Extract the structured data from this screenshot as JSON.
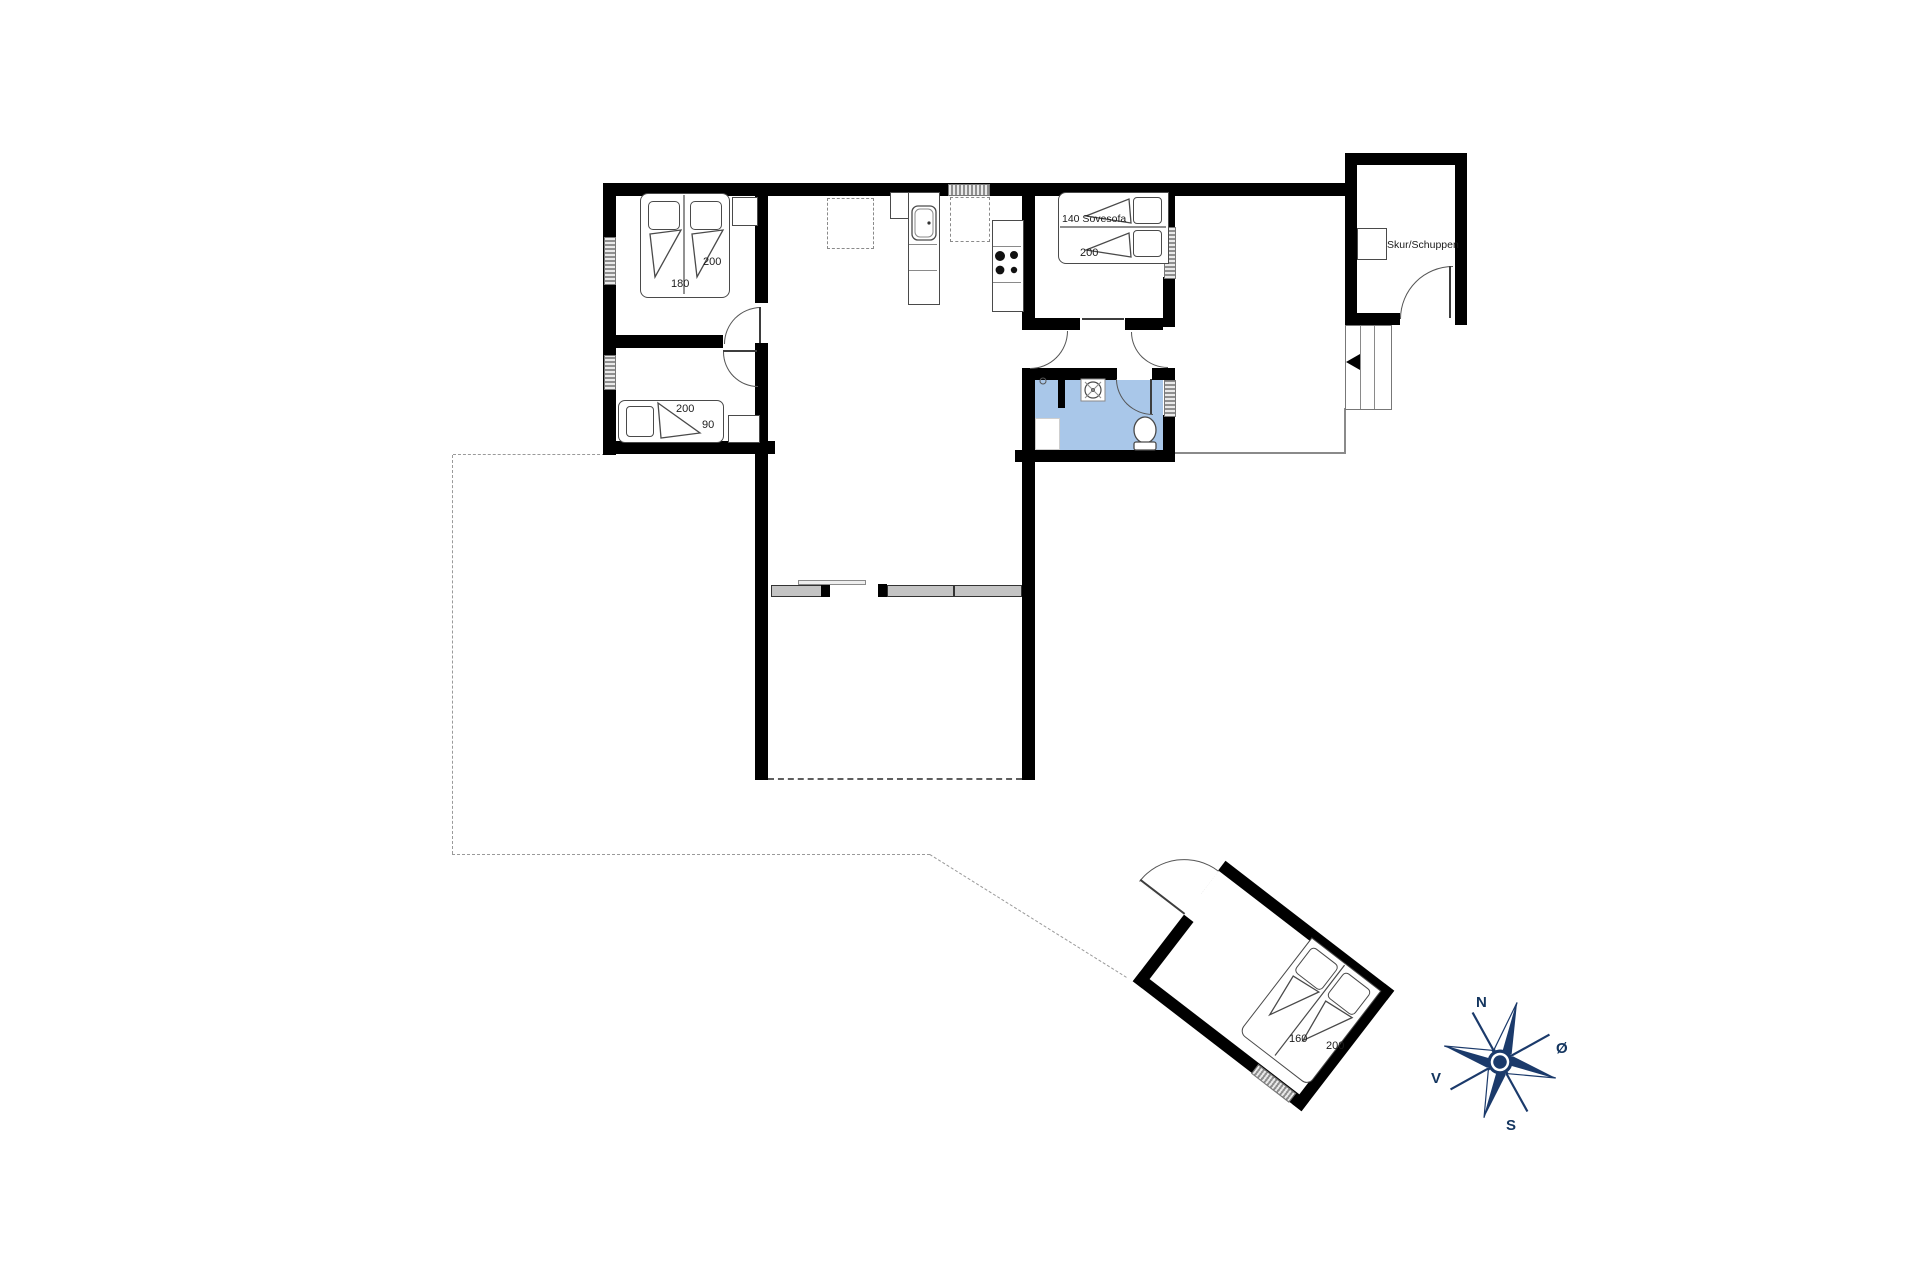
{
  "colors": {
    "wall": "#000000",
    "bathroom_fill": "#a9c7e9",
    "compass_navy": "#1b3a6b",
    "window_gray": "#b3b3b3",
    "dash_gray": "#999999"
  },
  "rooms": {
    "bedroom1": {
      "bed_width_label": "180",
      "bed_length_label": "200"
    },
    "bedroom2": {
      "bed_length_label": "200",
      "bed_width_label": "90"
    },
    "bedroom3": {
      "sofa_label": "140 Sovesofa",
      "bed_length_label": "200"
    },
    "shed": {
      "name_label": "Skur/Schuppen"
    },
    "annex": {
      "bed_width_label": "160",
      "bed_length_label": "200"
    }
  },
  "compass": {
    "north": "N",
    "east": "Ø",
    "south": "S",
    "west": "V"
  }
}
